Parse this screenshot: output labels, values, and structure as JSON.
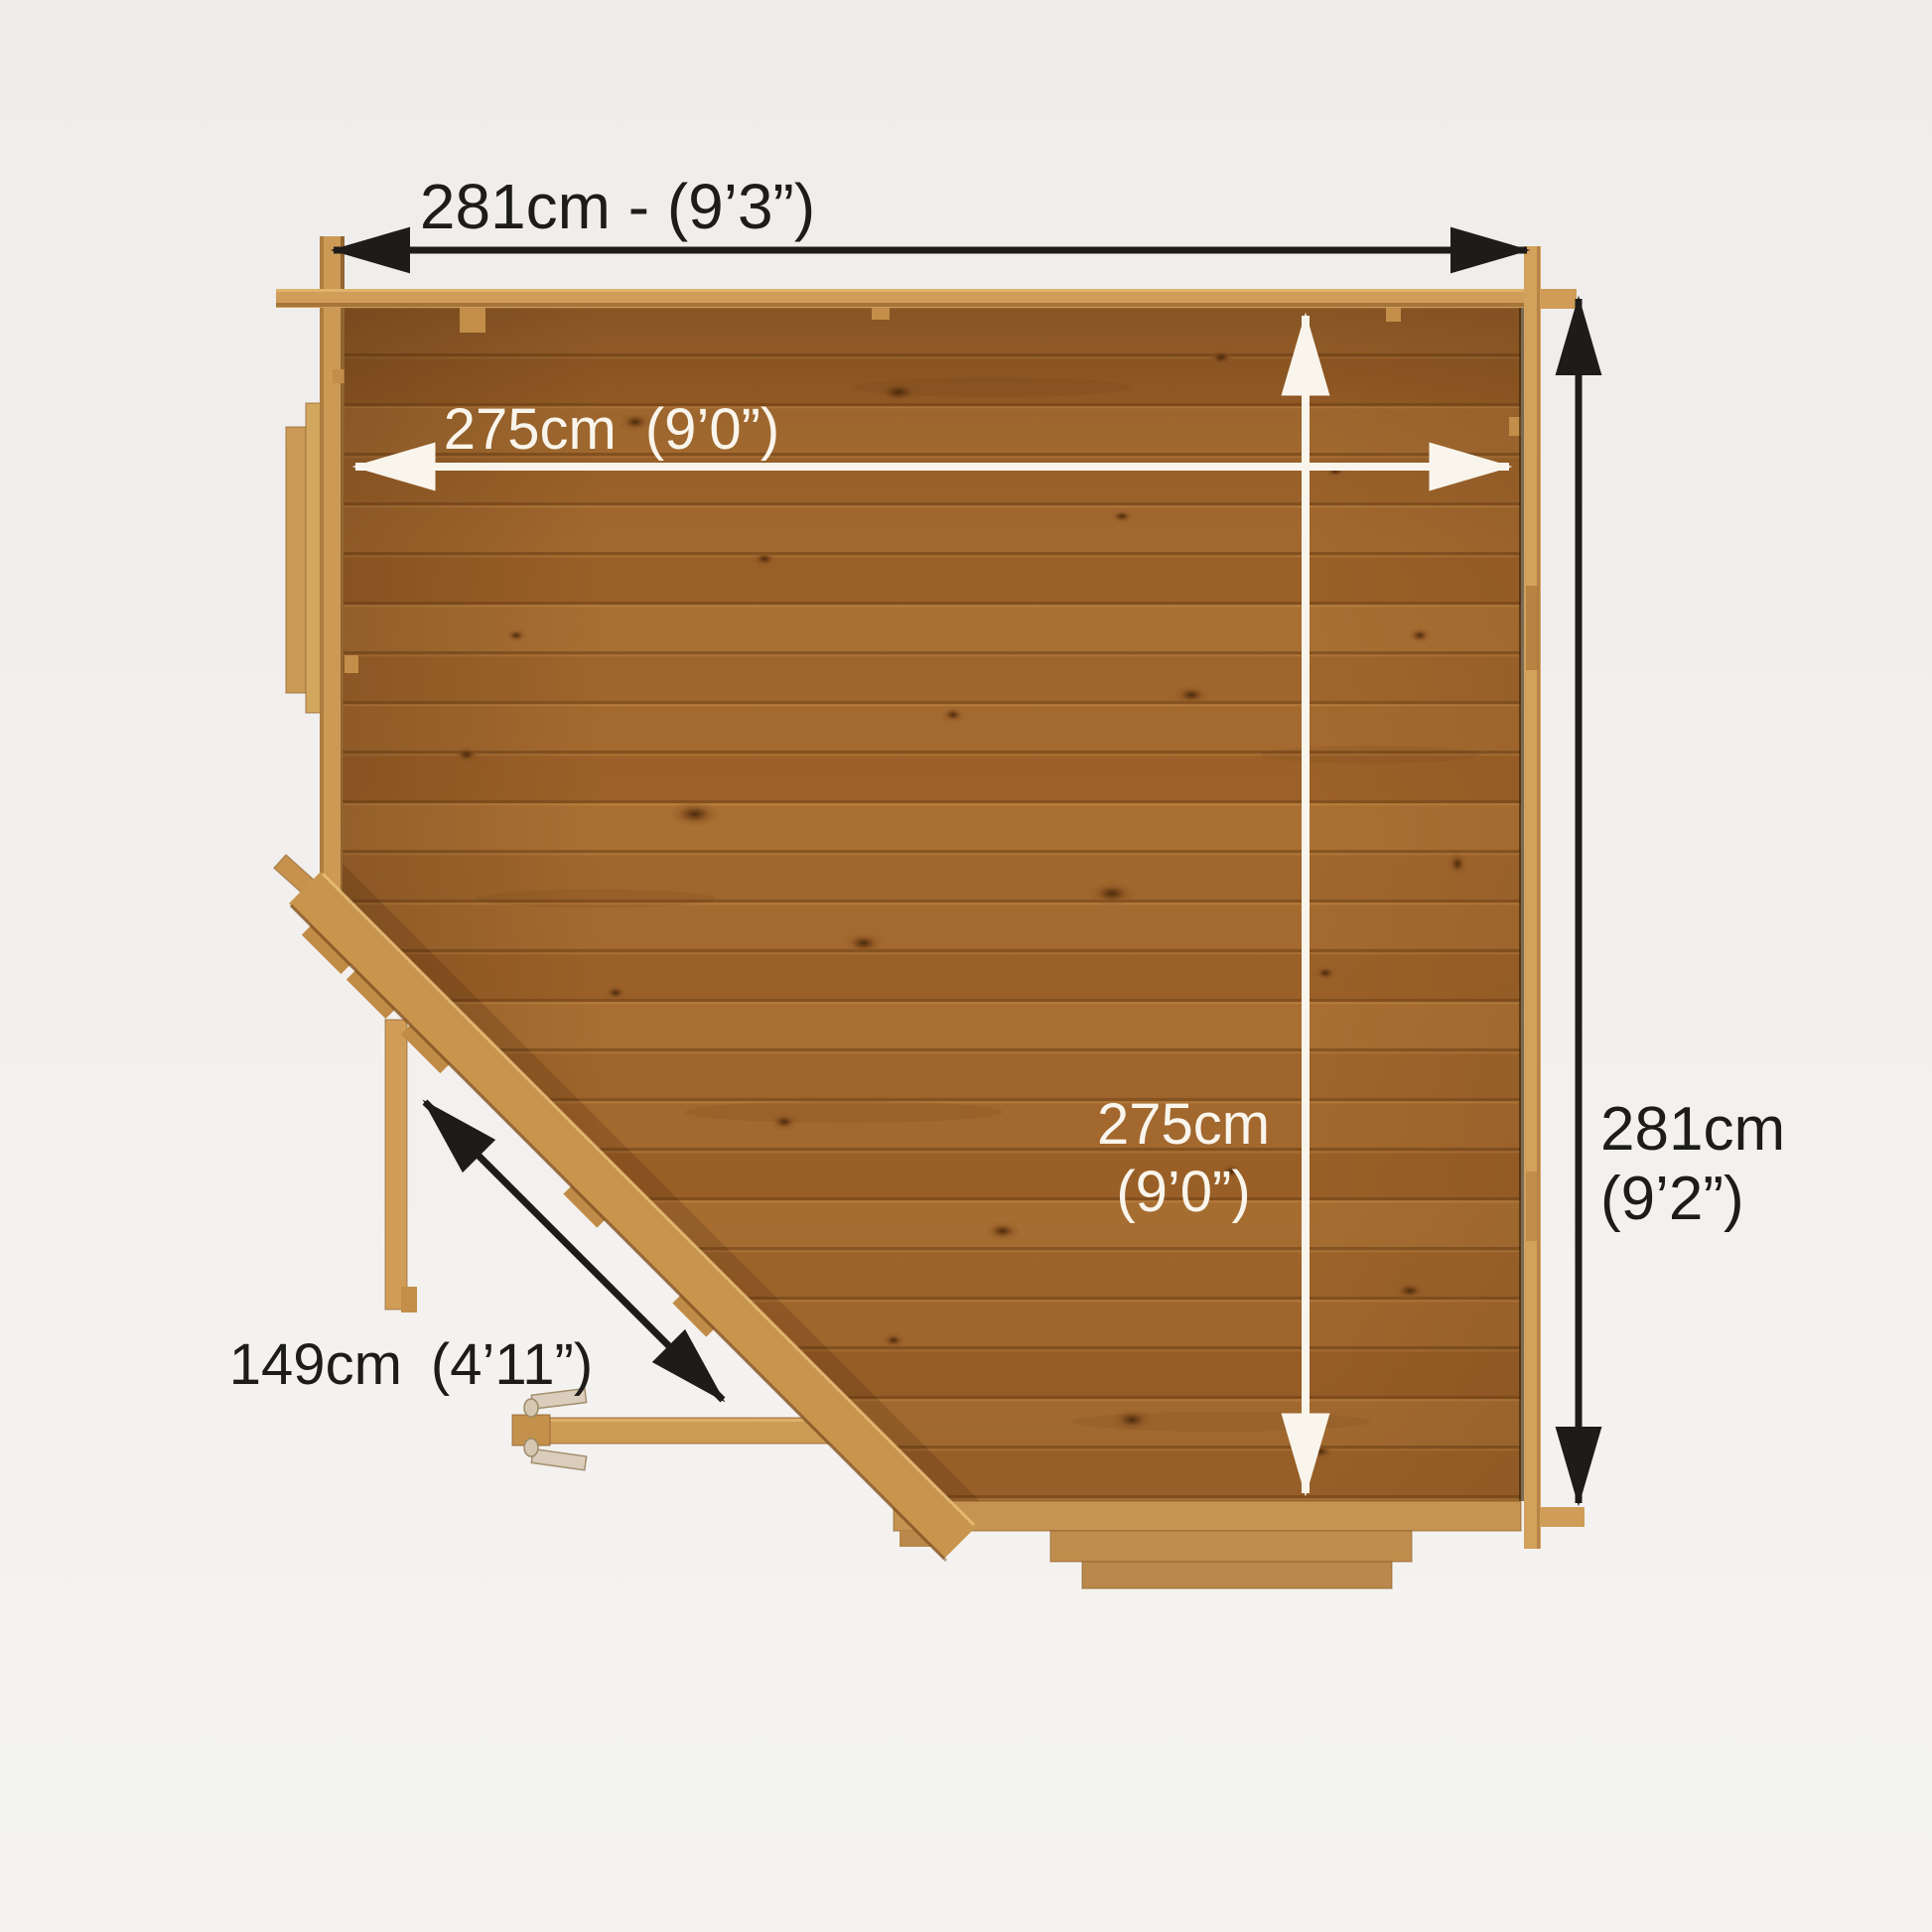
{
  "page": {
    "background": "#f2f0ee",
    "description": "Top-down floor plan diagram of a corner log cabin with dimension arrows"
  },
  "diagram": {
    "type": "floor-plan-top-view",
    "subject": "corner summerhouse / log cabin",
    "colors": {
      "floor_wood": "#a2672c",
      "wall_wood": "#cf9c57",
      "trim_wood": "#d2a15b",
      "step_wood": "#c09050",
      "annotation_dark": "#1d1c1a",
      "annotation_light": "#f9f5ec"
    },
    "dimensions": {
      "overall_width": {
        "label": "281cm - (9’3”)"
      },
      "internal_width": {
        "label": "275cm (9’0”)"
      },
      "internal_depth": {
        "line1": "275cm",
        "line2": "(9’0”)"
      },
      "overall_depth": {
        "line1": "281cm",
        "line2": "(9’2”)"
      },
      "front_diagonal": {
        "label": "149cm (4’11”)"
      }
    }
  }
}
